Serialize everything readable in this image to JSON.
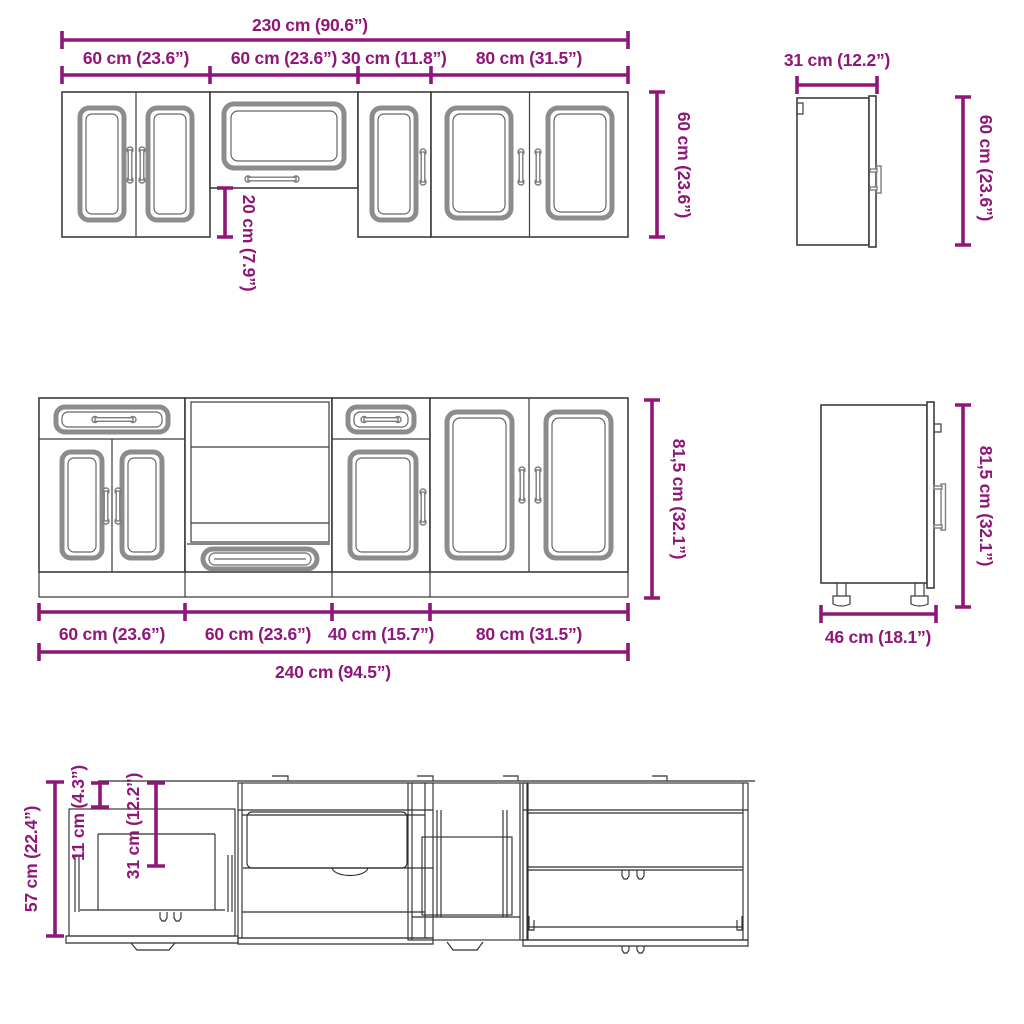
{
  "colors": {
    "dimension": "#8F1778",
    "outline": "#3d3d3d",
    "panel_gray": "#8c8c8c"
  },
  "wall_cabinets_front": {
    "total_width": "230 cm (90.6”)",
    "segments": [
      "60 cm (23.6”)",
      "60 cm (23.6”)",
      "30 cm (11.8”)",
      "80 cm (31.5”)"
    ],
    "height": "60 cm (23.6”)",
    "hood_cabinet_offset": "20 cm (7.9”)"
  },
  "wall_cabinet_side": {
    "depth": "31 cm (12.2”)",
    "height": "60 cm (23.6”)"
  },
  "base_cabinets_front": {
    "segments": [
      "60 cm (23.6”)",
      "60 cm (23.6”)",
      "40 cm (15.7”)",
      "80 cm (31.5”)"
    ],
    "total_width": "240 cm (94.5”)",
    "height": "81,5 cm (32.1”)"
  },
  "base_cabinet_side": {
    "depth": "46 cm (18.1”)",
    "height": "81,5 cm (32.1”)"
  },
  "drawer_detail": {
    "cabinet_height": "57 cm (22.4”)",
    "drawer_front_height": "11 cm (4.3”)",
    "opening_height": "31 cm (12.2”)"
  }
}
